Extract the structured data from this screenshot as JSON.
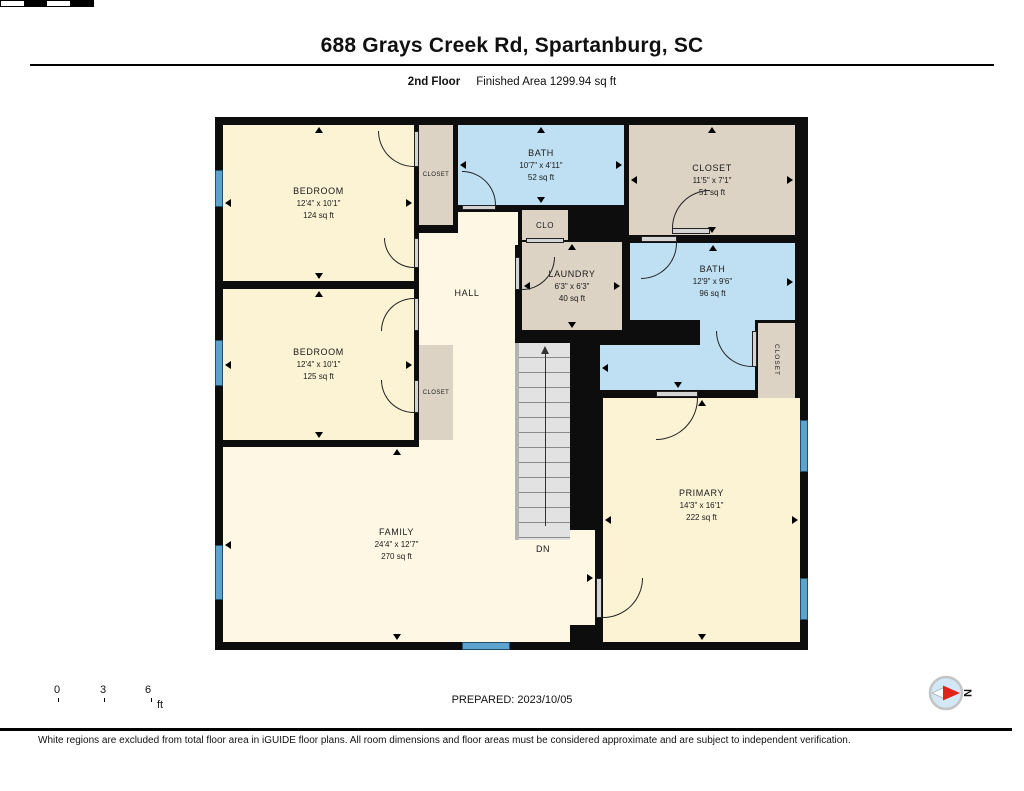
{
  "header": {
    "title": "688 Grays Creek Rd, Spartanburg, SC",
    "floor_label": "2nd Floor",
    "area_label": "Finished Area 1299.94 sq ft"
  },
  "rooms": {
    "bedroom1": {
      "name": "BEDROOM",
      "dims": "12'4\" x 10'1\"",
      "area": "124 sq ft"
    },
    "bedroom2": {
      "name": "BEDROOM",
      "dims": "12'4\" x 10'1\"",
      "area": "125 sq ft"
    },
    "bath1": {
      "name": "BATH",
      "dims": "10'7\" x 4'11\"",
      "area": "52 sq ft"
    },
    "closet_top": {
      "name": "CLOSET",
      "dims": "11'5\" x 7'1\"",
      "area": "51 sq ft"
    },
    "laundry": {
      "name": "LAUNDRY",
      "dims": "6'3\" x 6'3\"",
      "area": "40 sq ft"
    },
    "bath2": {
      "name": "BATH",
      "dims": "12'9\" x 9'6\"",
      "area": "96 sq ft"
    },
    "family": {
      "name": "FAMILY",
      "dims": "24'4\" x 12'7\"",
      "area": "270 sq ft"
    },
    "primary": {
      "name": "PRIMARY",
      "dims": "14'3\" x 16'1\"",
      "area": "222 sq ft"
    },
    "hall": {
      "name": "HALL"
    },
    "clo": {
      "name": "CLO"
    },
    "closet_small1": {
      "name": "CLOSET"
    },
    "closet_small2": {
      "name": "CLOSET"
    },
    "closet_vert": {
      "name": "CLOSET"
    },
    "stairs": {
      "label": "DN"
    }
  },
  "scale_bar": {
    "tick0": "0",
    "tick1": "3",
    "tick2": "6",
    "unit": "ft"
  },
  "prepared_label": "PREPARED: 2023/10/05",
  "compass": {
    "label": "N"
  },
  "footer": {
    "disclaimer": "White regions are excluded from total floor area in iGUIDE floor plans. All room dimensions and floor areas must be considered approximate and are subject to independent verification."
  },
  "colors": {
    "room_cream": "#fcf2d4",
    "room_cream_light": "#fdf7e4",
    "bath_blue": "#bfe0f2",
    "closet_tan": "#ddd3c5",
    "window_blue": "#5ea3ce",
    "wall_black": "#0d0d0d",
    "stair_gray": "#dcdcdc",
    "door_gray": "#d4d4d4",
    "compass_red": "#e02417"
  }
}
